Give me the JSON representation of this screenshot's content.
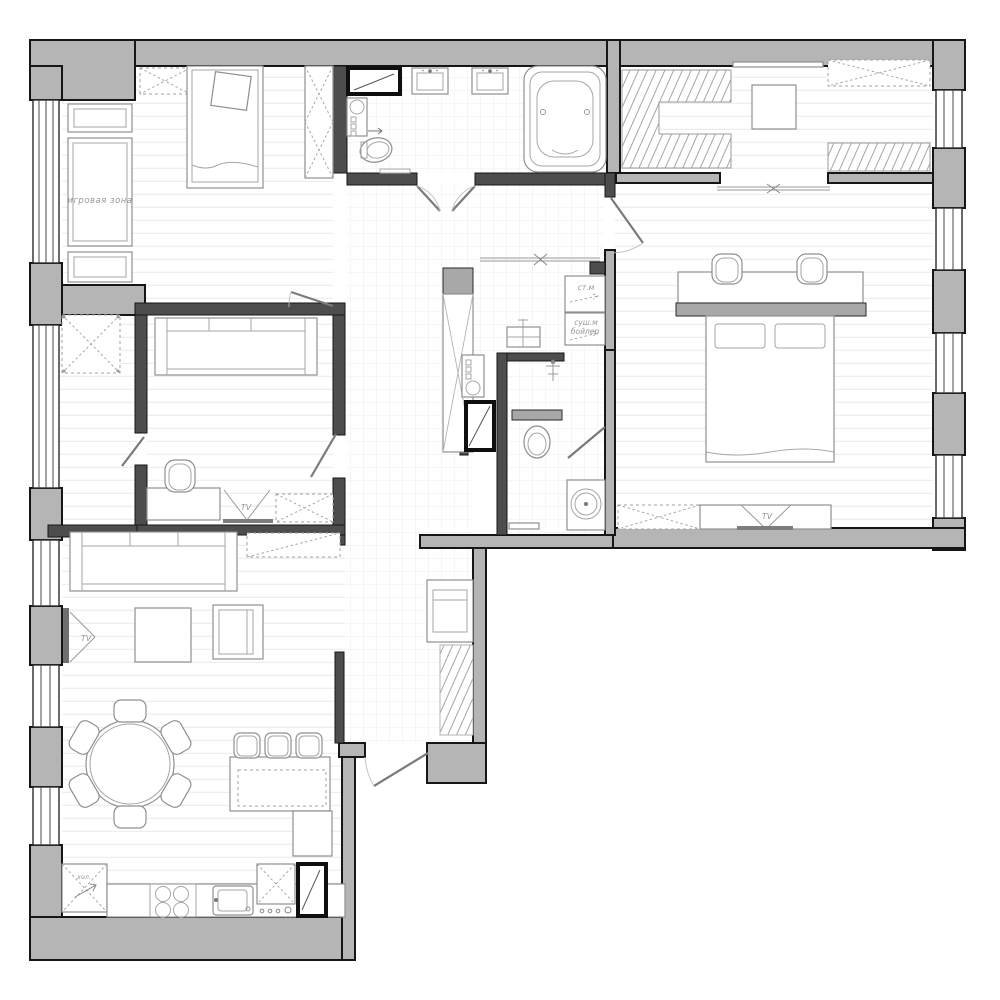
{
  "drawing": {
    "type": "apartment floor plan",
    "labels": {
      "play_zone": "игровая зона",
      "washer": "ст.м",
      "dryer": "суш.м",
      "boiler": "бойлер",
      "tv": "TV",
      "fridge": "хол."
    },
    "colors": {
      "exterior_wall": "#b5b5b5",
      "partition_wall": "#4d4d4d",
      "outline": "#161616",
      "furniture_stroke": "#8f8f8f",
      "label_text": "#979797",
      "floor": "#ffffff"
    }
  }
}
